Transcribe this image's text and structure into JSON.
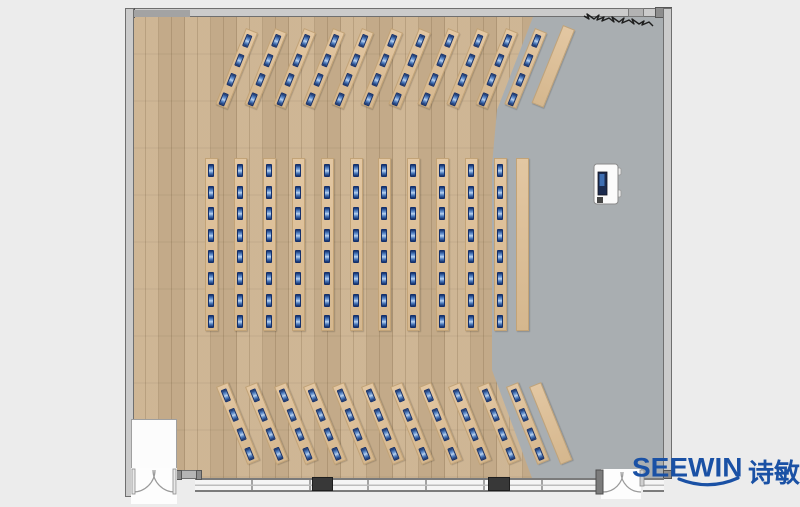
{
  "title": "classroom-floor-plan",
  "logo": {
    "brand": "SEEWIN",
    "cjk": "诗敏"
  },
  "palette": {
    "canvas_bg": "#ececec",
    "wood_floor": "#ccb28f",
    "gray_floor": "#a9aeb1",
    "desk_fill": "#ddc19b",
    "desk_edge": "#c2a377",
    "monitor_navy": "#14306b",
    "monitor_blue": "#8fb3e2",
    "wall_fill": "#cbcbcb",
    "wall_edge": "#6f6f6f",
    "pillar": "#383838",
    "logo_blue": "#1a51a5"
  },
  "floorplan": {
    "blocks": [
      {
        "id": "front",
        "desk_rows": 11,
        "seats_per_row": 4,
        "angle_deg": 22,
        "empty_side_tables": 1
      },
      {
        "id": "center",
        "desk_rows": 11,
        "seats_per_row": 8,
        "angle_deg": 0,
        "empty_side_tables": 1
      },
      {
        "id": "back",
        "desk_rows": 11,
        "seats_per_row": 4,
        "angle_deg": -22,
        "empty_side_tables": 1
      }
    ],
    "total_seats": 176,
    "features": [
      "wood-floor-area",
      "gray-floor-area",
      "presenter-cart",
      "double-door-south-west",
      "double-door-south-east",
      "window-wall-south",
      "pillar-columns",
      "wall-scribble-decoration"
    ]
  }
}
